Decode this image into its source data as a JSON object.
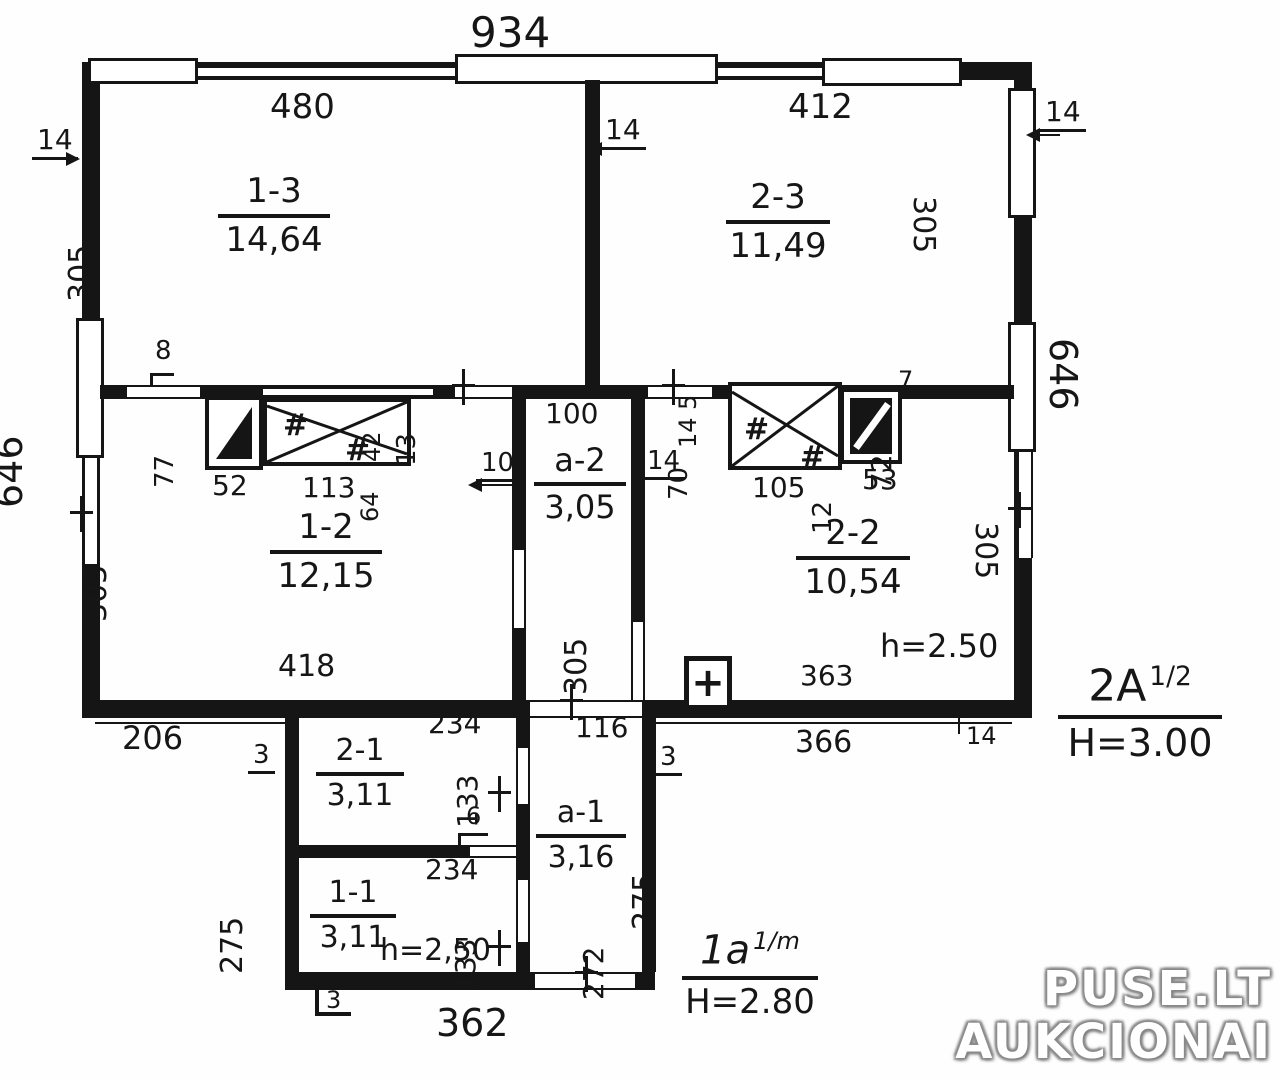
{
  "watermark": {
    "line1": "PUSE.LT",
    "line2": "AUKCIONAI"
  },
  "notes": {
    "note_right": {
      "code": "2A",
      "frac": "1/2",
      "height": "H=3.00"
    },
    "note_bottom": {
      "code": "1a",
      "frac": "1/m",
      "height": "H=2.80"
    },
    "ceiling_upper": "h=2.50",
    "ceiling_lower": "h=2,50"
  },
  "rooms": {
    "r13": {
      "id": "1-3",
      "area": "14,64"
    },
    "r23": {
      "id": "2-3",
      "area": "11,49"
    },
    "r12": {
      "id": "1-2",
      "area": "12,15"
    },
    "a2": {
      "id": "a-2",
      "area": "3,05"
    },
    "r22": {
      "id": "2-2",
      "area": "10,54"
    },
    "r21": {
      "id": "2-1",
      "area": "3,11"
    },
    "r11": {
      "id": "1-1",
      "area": "3,11"
    },
    "a1": {
      "id": "a-1",
      "area": "3,16"
    }
  },
  "dims": {
    "top_overall": "934",
    "top_left_room": "480",
    "top_right_room": "412",
    "wall14_left": "14",
    "wall14_mid": "14",
    "wall14_right": "14",
    "wall14_bottom": "14",
    "wall14_a2": "14",
    "v305_tl": "305",
    "v305_tr": "305",
    "v305_bl": "305",
    "v305_br": "305",
    "v305_a2": "305",
    "v646_l": "646",
    "v646_r": "646",
    "seg8": "8",
    "seg77": "77",
    "seg52": "52",
    "seg113": "113",
    "seg42": "42",
    "seg64": "64",
    "seg13": "13",
    "a2_width": "100",
    "seg10": "10",
    "seg5": "5",
    "seg14": "14",
    "seg70": "70",
    "seg105": "105",
    "seg12": "12",
    "seg53": "53",
    "seg72": "72",
    "seg7": "7",
    "d418": "418",
    "d363": "363",
    "d366": "366",
    "d206": "206",
    "d234_top": "234",
    "d234_mid": "234",
    "d116": "116",
    "v133_top": "133",
    "v133_bot": "133",
    "v272": "272",
    "v275_l": "275",
    "v275_r": "275",
    "seg3_left": "3",
    "seg3_right": "3",
    "seg3_bottom": "3",
    "seg6": "6",
    "d362": "362"
  },
  "symbols": {
    "hash": "#",
    "plus": "+"
  }
}
